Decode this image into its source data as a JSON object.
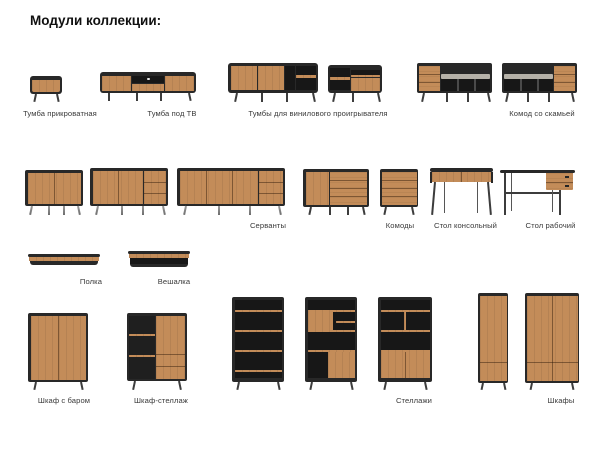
{
  "page": {
    "title": "Модули коллекции:"
  },
  "colors": {
    "background": "#ffffff",
    "wood": "#c38c59",
    "frame_black": "#282828",
    "niche_dark": "#171717",
    "cushion_grey": "#b6b2a9",
    "metal_leg": "#8d8d8d",
    "label_text": "#3a3a3a"
  },
  "labels": {
    "bedside": "Тумба прикроватная",
    "tv_stand": "Тумба под ТВ",
    "vinyl_stands": "Тумбы для винилового проигрывателя",
    "bench_chest": "Комод со скамьей",
    "sideboards": "Серванты",
    "dressers": "Комоды",
    "console_table": "Стол консольный",
    "desk": "Стол рабочий",
    "shelf": "Полка",
    "hanger": "Вешалка",
    "bar_cabinet": "Шкаф с баром",
    "cabinet_shelving": "Шкаф-стеллаж",
    "racks": "Стеллажи",
    "wardrobes": "Шкафы"
  }
}
